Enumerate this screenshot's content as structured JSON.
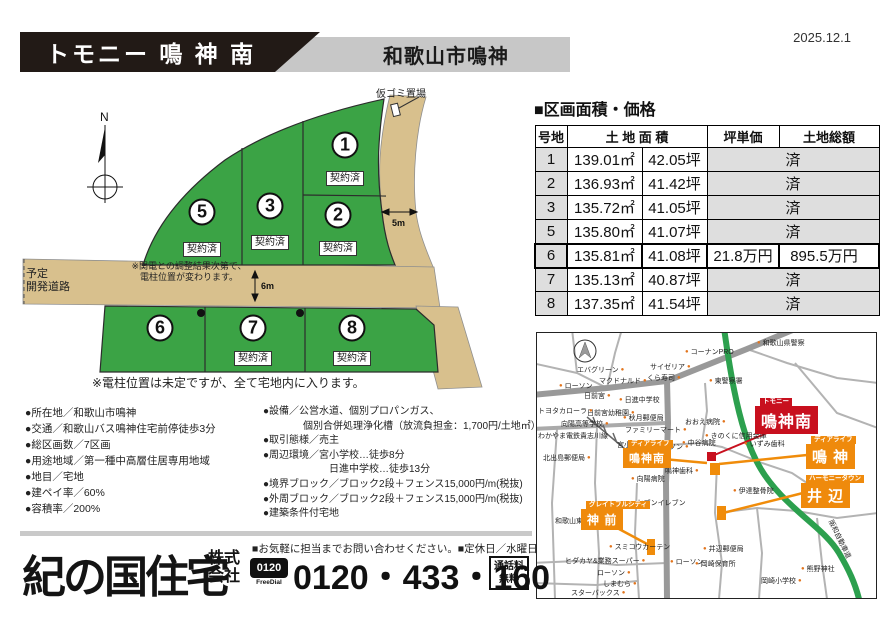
{
  "date": "2025.12.1",
  "header": {
    "title": "トモニー 鳴 神 南",
    "subtitle": "和歌山市鳴神"
  },
  "siteplan": {
    "compass": "N",
    "garbage": "仮ゴミ置場",
    "width5": "5m",
    "width6": "6m",
    "planned1": "予定",
    "planned2": "開発道路",
    "note1": "※関電との調整結果次第で、",
    "note2": "電柱位置が変わります。",
    "bottom_note": "※電柱位置は未定ですが、全て宅地内に入ります。",
    "sold": "契約済",
    "lots": [
      {
        "no": "1",
        "x": 325,
        "y": 60,
        "sold": true,
        "ly": 86
      },
      {
        "no": "2",
        "x": 318,
        "y": 130,
        "sold": true,
        "ly": 156
      },
      {
        "no": "3",
        "x": 250,
        "y": 121,
        "sold": true,
        "ly": 150
      },
      {
        "no": "5",
        "x": 182,
        "y": 127,
        "sold": true,
        "ly": 157
      },
      {
        "no": "6",
        "x": 140,
        "y": 243,
        "sold": false,
        "ly": 0
      },
      {
        "no": "7",
        "x": 233,
        "y": 243,
        "sold": true,
        "ly": 266
      },
      {
        "no": "8",
        "x": 332,
        "y": 243,
        "sold": true,
        "ly": 266
      }
    ]
  },
  "price_table": {
    "title": "■区画面積・価格",
    "col_lot": "号地",
    "col_area": "土 地 面 積",
    "col_unit": "坪単価",
    "col_total": "土地総額",
    "rows": [
      {
        "lot": "1",
        "m2": "139.01㎡",
        "tsubo": "42.05坪",
        "status": "済"
      },
      {
        "lot": "2",
        "m2": "136.93㎡",
        "tsubo": "41.42坪",
        "status": "済"
      },
      {
        "lot": "3",
        "m2": "135.72㎡",
        "tsubo": "41.05坪",
        "status": "済"
      },
      {
        "lot": "5",
        "m2": "135.80㎡",
        "tsubo": "41.07坪",
        "status": "済"
      },
      {
        "lot": "6",
        "m2": "135.81㎡",
        "tsubo": "41.08坪",
        "unit": "21.8万円",
        "total": "895.5万円"
      },
      {
        "lot": "7",
        "m2": "135.13㎡",
        "tsubo": "40.87坪",
        "status": "済"
      },
      {
        "lot": "8",
        "m2": "137.35㎡",
        "tsubo": "41.54坪",
        "status": "済"
      }
    ]
  },
  "details": {
    "left": [
      {
        "t": "●所在地／和歌山市鳴神"
      },
      {
        "t": "●交通／和歌山バス鳴神住宅前停徒歩3分"
      },
      {
        "t": "●総区画数／7区画"
      },
      {
        "t": "●用途地域／第一種中高層住居専用地域"
      },
      {
        "t": "●地目／宅地"
      },
      {
        "t": "●建ペイ率／60%"
      },
      {
        "t": "●容積率／200%"
      }
    ],
    "right": [
      {
        "t": "●設備／公営水道、個別プロパンガス、"
      },
      {
        "t": "個別合併処理浄化槽（放流負担金：1,700円/土地㎡）",
        "indent": 40
      },
      {
        "t": "●取引態様／売主"
      },
      {
        "t": "●周辺環境／宮小学校…徒歩8分"
      },
      {
        "t": "日進中学校…徒歩13分",
        "indent": 66
      },
      {
        "t": "●境界ブロック／ブロック2段＋フェンス15,000円/m(税抜)"
      },
      {
        "t": "●外周ブロック／ブロック2段＋フェンス15,000円/m(税抜)"
      },
      {
        "t": "●建築条件付宅地"
      }
    ]
  },
  "map": {
    "labels": [
      {
        "t": "エバグリーン",
        "x": 40,
        "y": 33,
        "dot": "r"
      },
      {
        "t": "ローソン",
        "x": 22,
        "y": 49,
        "dot": "l"
      },
      {
        "t": "マクドナルド",
        "x": 62,
        "y": 44,
        "dot": "r"
      },
      {
        "t": "サイゼリア",
        "x": 113,
        "y": 30,
        "dot": "r"
      },
      {
        "t": "くら寿司",
        "x": 110,
        "y": 41,
        "dot": "r"
      },
      {
        "t": "コーナンPRO",
        "x": 148,
        "y": 15,
        "dot": "l"
      },
      {
        "t": "東警察署",
        "x": 172,
        "y": 44,
        "dot": "l"
      },
      {
        "t": "和歌山県警察",
        "x": 220,
        "y": 6,
        "dot": "l"
      },
      {
        "t": "日前宮",
        "x": 47,
        "y": 59,
        "dot": "r"
      },
      {
        "t": "日進中学校",
        "x": 82,
        "y": 63,
        "dot": "l"
      },
      {
        "t": "日前宮幼稚園",
        "x": 50,
        "y": 76,
        "dot": "r"
      },
      {
        "t": "向陽高等学校",
        "x": 24,
        "y": 87,
        "dot": "r"
      },
      {
        "t": "トヨタカローラ",
        "x": 1,
        "y": 74,
        "dot": "r"
      },
      {
        "t": "わかやま電鉄貴志川線",
        "x": 1,
        "y": 100,
        "dot": "n"
      },
      {
        "t": "秋月郵便局",
        "x": 86,
        "y": 81,
        "dot": "l"
      },
      {
        "t": "ファミリーマート",
        "x": 88,
        "y": 93,
        "dot": "r"
      },
      {
        "t": "宮小学校",
        "x": 80,
        "y": 108,
        "dot": "r"
      },
      {
        "t": "おおえ病院",
        "x": 148,
        "y": 85,
        "dot": "r"
      },
      {
        "t": "ローソン",
        "x": 118,
        "y": 110,
        "dot": "r"
      },
      {
        "t": "中谷病院",
        "x": 145,
        "y": 106,
        "dot": "l"
      },
      {
        "t": "きのくに信用金庫",
        "x": 168,
        "y": 99,
        "dot": "l"
      },
      {
        "t": "いずみ歯科",
        "x": 207,
        "y": 107,
        "dot": "l"
      },
      {
        "t": "鳴神歯科",
        "x": 128,
        "y": 134,
        "dot": "r"
      },
      {
        "t": "向陽病院",
        "x": 94,
        "y": 142,
        "dot": "l"
      },
      {
        "t": "セブンイレブン",
        "x": 94,
        "y": 166,
        "dot": "l"
      },
      {
        "t": "伊達整骨院",
        "x": 196,
        "y": 154,
        "dot": "l"
      },
      {
        "t": "北出島郵便局",
        "x": 6,
        "y": 121,
        "dot": "r"
      },
      {
        "t": "和歌山東公園",
        "x": 18,
        "y": 184,
        "dot": "r"
      },
      {
        "t": "スミコウカーテン",
        "x": 72,
        "y": 210,
        "dot": "l"
      },
      {
        "t": "ヒダカヤ&業務スーパー",
        "x": 28,
        "y": 224,
        "dot": "r"
      },
      {
        "t": "ローソン",
        "x": 60,
        "y": 236,
        "dot": "r"
      },
      {
        "t": "しまむら",
        "x": 66,
        "y": 247,
        "dot": "r"
      },
      {
        "t": "スターバックス",
        "x": 34,
        "y": 256,
        "dot": "r"
      },
      {
        "t": "ローソン",
        "x": 133,
        "y": 225,
        "dot": "l"
      },
      {
        "t": "井辺郵便局",
        "x": 166,
        "y": 212,
        "dot": "l"
      },
      {
        "t": "岡崎保育所",
        "x": 158,
        "y": 227,
        "dot": "l"
      },
      {
        "t": "岡崎小学校",
        "x": 224,
        "y": 244,
        "dot": "r"
      },
      {
        "t": "熊野神社",
        "x": 264,
        "y": 232,
        "dot": "l"
      },
      {
        "t": "阪和自動車道",
        "x": 296,
        "y": 186,
        "dot": "n",
        "rot": 64
      }
    ],
    "badges": [
      {
        "tag": "トモニー",
        "name": "鳴神南",
        "color": "#c8101e",
        "x": 218,
        "y": 73,
        "fs": 16
      },
      {
        "tag": "ディアライフ",
        "name": "鳴 神",
        "color": "#ef8a0c",
        "x": 269,
        "y": 111,
        "fs": 15
      },
      {
        "tag": "ハーモニータウン",
        "name": "井 辺",
        "color": "#ef8a0c",
        "x": 264,
        "y": 150,
        "fs": 15
      },
      {
        "tag": "ディアライフ",
        "name": "鳴神南",
        "color": "#ef8a0c",
        "x": 86,
        "y": 115,
        "fs": 11
      },
      {
        "tag": "グレイトフルシティ",
        "name": "神 前",
        "color": "#ef8a0c",
        "x": 44,
        "y": 176,
        "fs": 12
      }
    ]
  },
  "footer": {
    "note": "■お気軽に担当までお問い合わせください。■定休日／水曜日",
    "company": "紀の国住宅",
    "suffix1": "株式",
    "suffix2": "会社",
    "freedial1": "0120",
    "freedial2": "FreeDial",
    "phone": "0120・433・160",
    "toll1": "通話料",
    "toll2": "無料"
  }
}
